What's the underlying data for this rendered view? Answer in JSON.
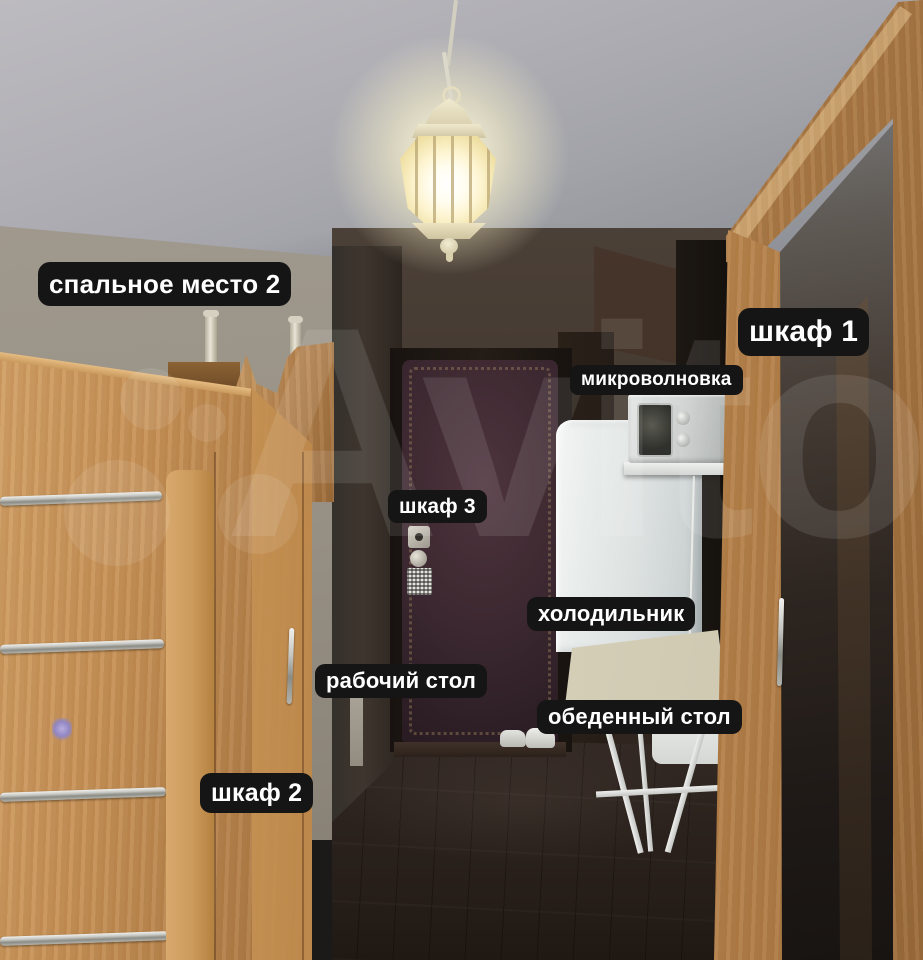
{
  "palette": {
    "label-bg": "#151515",
    "label-text": "#ffffff",
    "watermark-color": "rgba(255,255,255,0.10)",
    "wood-light": "#d2a066",
    "wood-mid": "#c08c52",
    "wood-dark": "#9a6a39",
    "ceiling-gray": "#aeadb3",
    "wall-tan": "#a09a8e",
    "hall-brown": "#3e352d",
    "floor-brown": "#241c19",
    "door-aubergine": "#3a272e",
    "fridge-white": "#e4e8e7",
    "lamp-glow": "#fff6cf"
  },
  "watermark": {
    "text": "Avito"
  },
  "annotations": [
    {
      "id": "sleeping-place-2",
      "text": "спальное место 2"
    },
    {
      "id": "wardrobe-1",
      "text": "шкаф 1"
    },
    {
      "id": "microwave",
      "text": "микроволновка"
    },
    {
      "id": "wardrobe-3",
      "text": "шкаф 3"
    },
    {
      "id": "fridge",
      "text": "холодильник"
    },
    {
      "id": "work-desk",
      "text": "рабочий стол"
    },
    {
      "id": "dining-table",
      "text": "обеденный стол"
    },
    {
      "id": "wardrobe-2",
      "text": "шкаф 2"
    }
  ]
}
